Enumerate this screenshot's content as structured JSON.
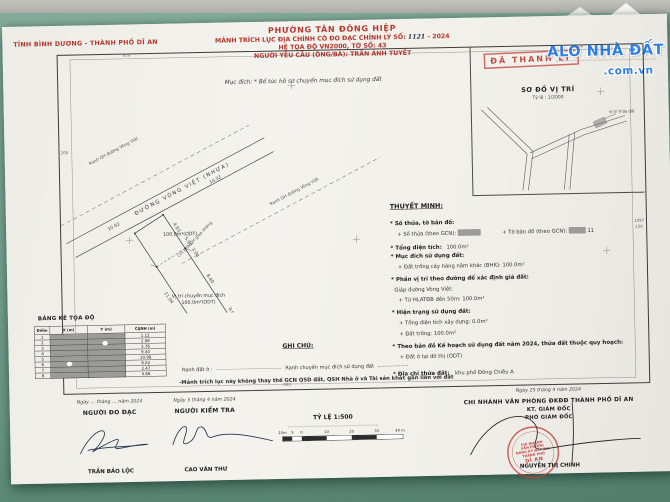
{
  "photo": {
    "background_green": "#7aa495",
    "top_strip_gray": "#b5b6b0",
    "paper_white": "#f0efe9",
    "accent_red": "#b5372e",
    "watermark_blue": "#2e7fe8"
  },
  "province_line": "TỈNH BÌNH DƯƠNG - THÀNH PHỐ DĨ AN",
  "header": {
    "line1": "PHƯỜNG TÂN ĐÔNG HIỆP",
    "line2_prefix": "MẢNH TRÍCH LỤC ĐỊA CHÍNH CÓ ĐO ĐẠC CHỈNH LÝ SỐ:",
    "line2_number": "1121",
    "line2_suffix": "- 2024",
    "line3": "HỆ TỌA ĐỘ VN2000, TỜ SỐ: 43",
    "line4": "NGƯỜI YÊU CẦU (ÔNG/BÀ): TRẦN ÁNH TUYẾT"
  },
  "stamps": {
    "da_thanh_ly": "ĐÃ THANH LÝ"
  },
  "watermark": {
    "line1": "ALO NHÀ ĐẤT",
    "line2": ".com.vn"
  },
  "purpose_line": "Mục đích: * Bổ túc hồ sơ chuyển mục đích sử dụng đất",
  "location_sketch": {
    "title": "SƠ ĐỒ VỊ TRÍ",
    "scale": "Tỷ lệ : 1/2000",
    "parcel_label": "vị trí thửa đất"
  },
  "drawing": {
    "road_name": "ĐƯỜNG VÒNG VIỆT (NHỰA)",
    "qh_label_left": "Ranh QH đường Vòng Việt",
    "qh_label_right": "Ranh QH đường Vòng Việt",
    "left_label": "Chỉ giới QH giao thông",
    "parcel1_area": "100.0m²(ODT)",
    "parcel2_label": "Vị trí chuyển mục đích",
    "parcel2_area": "100.0m²(ODT)",
    "dims": [
      "10.02",
      "14.32",
      "4.03",
      "5.00",
      "3.00",
      "8.40",
      "9.62",
      "11.94",
      "6.30",
      "2.48"
    ]
  },
  "thuyet_minh": {
    "title": "THUYẾT MINH:",
    "l1": "* Số thửa, tờ bản đồ:",
    "so_thua_label": "+ Số thửa (theo GCN):",
    "to_ban_do_label": "+ Tờ bản đồ (theo GCN):",
    "to_ban_do_value": "11",
    "tong_dt_label": "* Tổng diện tích:",
    "tong_dt_value": "100.0m²",
    "muc_dich": "* Mục đích sử dụng đất:",
    "bhk": "+ Đất trồng cây hàng năm khác (BHK): 100.0m²",
    "phan_vi_tri": "* Phần vị trí theo đường để xác định giá đất:",
    "giap_duong": "Giáp đường Vòng Việt:",
    "hlatdb": "+ Từ HLATĐB đến 50m: 100.0m²",
    "hien_trang": "* Hiện trạng sử dụng đất:",
    "xay_dung": "+ Tổng diện tích xây dựng: 0.0m²",
    "dat_trong": "+ Đất trống: 100.0m²",
    "quy_hoach": "* Theo bản đồ Kế hoạch sử dụng đất năm 2024, thửa đất thuộc quy hoạch:",
    "odt": "+ Đất ở tại đô thị (ODT)",
    "dia_chi_label": "* Địa chỉ thửa đất:",
    "dia_chi_value": "khu phố Đông Chiêu A"
  },
  "table": {
    "title": "BẢNG KÊ TỌA ĐỘ",
    "headers": [
      "Điểm",
      "X (m)",
      "Y (m)",
      "CẠNH (m)"
    ],
    "diem": [
      "1",
      "2",
      "3",
      "4",
      "5",
      "6",
      "7",
      "8"
    ],
    "canh": [
      "1.12",
      "2.06",
      "3.76",
      "9.40",
      "10.98",
      "8.82",
      "2.47",
      "4.66"
    ]
  },
  "ghi_chu": {
    "title": "GHI CHÚ:",
    "legend1": "Ranh đất ở :",
    "legend2": "Ranh chuyển mục đích sử dụng đất",
    "note": "-Mảnh trích lục này không thay thế GCN QSD đất, QSH Nhà ở và Tài sản khác gắn liền với đất"
  },
  "grid_labels": {
    "top_left": "959",
    "top_right": "100",
    "left": "200",
    "right_a": "1097",
    "right_b": "150",
    "bottom": "000"
  },
  "footer": {
    "col1": {
      "date": "Ngày … tháng … năm 2024",
      "role": "NGƯỜI ĐO ĐẠC",
      "name": "TRẦN BẢO LỘC"
    },
    "col2": {
      "date": "Ngày 3 tháng 4 năm 2024",
      "role": "NGƯỜI KIỂM TRA",
      "name": "CAO VĂN THƯ"
    },
    "scalebar": {
      "label": "TỶ LỆ 1:500",
      "ticks": [
        "10m",
        "5",
        "0",
        "10",
        "20",
        "30",
        "40 m"
      ]
    },
    "col3": {
      "date": "Ngày 25 tháng 4 năm 2024",
      "office": "CHI NHÁNH VĂN PHÒNG ĐKĐĐ THÀNH PHỐ DĨ AN",
      "kt": "KT. GIÁM ĐỐC",
      "deputy": "PHÓ GIÁM ĐỐC",
      "name": "NGUYỄN THỊ CHINH",
      "seal_lines": [
        "CHI NHÁNH",
        "VĂN PHÒNG",
        "ĐĂNG KÝ ĐẤT ĐAI",
        "THÀNH PHỐ",
        "DĨ AN"
      ]
    }
  }
}
